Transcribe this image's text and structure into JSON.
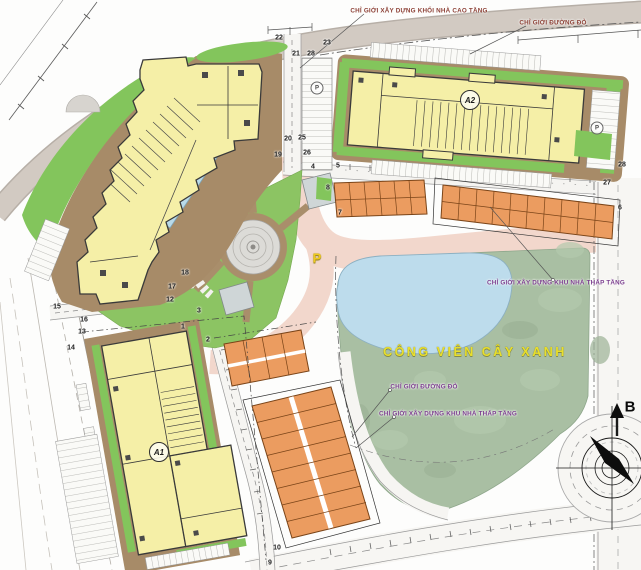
{
  "park": {
    "name": "CÔNG VIÊN CÂY XANH"
  },
  "compass": {
    "north_label": "B"
  },
  "buildings": {
    "a1_label": "A1",
    "a2_label": "A2",
    "parking_big_label": "P",
    "parking_lot_left_label": "P",
    "parking_lot_right_label": "P"
  },
  "annotations": [
    {
      "id": "boundary-highrise",
      "text": "CHỈ GIỚI XÂY DỰNG KHỐI NHÀ CAO TẦNG",
      "x": 419,
      "y": 11,
      "cls": "red"
    },
    {
      "id": "red-line-top",
      "text": "CHỈ GIỚI ĐƯỜNG ĐỎ",
      "x": 553,
      "y": 23,
      "cls": "red"
    },
    {
      "id": "boundary-lowrise-right",
      "text": "CHỈ GIỚI XÂY DỰNG KHU NHÀ THẤP TẦNG",
      "x": 556,
      "y": 283,
      "cls": "purple"
    },
    {
      "id": "red-line-park",
      "text": "CHỈ GIỚI ĐƯỜNG ĐỎ",
      "x": 424,
      "y": 387,
      "cls": "purple"
    },
    {
      "id": "boundary-lowrise-park",
      "text": "CHỈ GIỚI XÂY DỰNG KHU NHÀ THẤP TẦNG",
      "x": 448,
      "y": 414,
      "cls": "purple"
    }
  ],
  "markers": [
    {
      "n": "22",
      "x": 279,
      "y": 38
    },
    {
      "n": "23",
      "x": 327,
      "y": 43
    },
    {
      "n": "21",
      "x": 296,
      "y": 54
    },
    {
      "n": "28",
      "x": 311,
      "y": 54
    },
    {
      "n": "20",
      "x": 288,
      "y": 139
    },
    {
      "n": "25",
      "x": 302,
      "y": 138
    },
    {
      "n": "19",
      "x": 278,
      "y": 155
    },
    {
      "n": "26",
      "x": 307,
      "y": 153
    },
    {
      "n": "4",
      "x": 313,
      "y": 167
    },
    {
      "n": "5",
      "x": 338,
      "y": 166
    },
    {
      "n": "8",
      "x": 328,
      "y": 188
    },
    {
      "n": "7",
      "x": 340,
      "y": 213
    },
    {
      "n": "28",
      "x": 622,
      "y": 165
    },
    {
      "n": "27",
      "x": 607,
      "y": 183
    },
    {
      "n": "6",
      "x": 620,
      "y": 208
    },
    {
      "n": "18",
      "x": 185,
      "y": 273
    },
    {
      "n": "17",
      "x": 172,
      "y": 287
    },
    {
      "n": "12",
      "x": 170,
      "y": 300
    },
    {
      "n": "3",
      "x": 199,
      "y": 311
    },
    {
      "n": "1",
      "x": 183,
      "y": 327
    },
    {
      "n": "2",
      "x": 208,
      "y": 340
    },
    {
      "n": "15",
      "x": 57,
      "y": 307
    },
    {
      "n": "16",
      "x": 84,
      "y": 320
    },
    {
      "n": "13",
      "x": 82,
      "y": 332
    },
    {
      "n": "14",
      "x": 71,
      "y": 348
    },
    {
      "n": "9",
      "x": 270,
      "y": 563
    },
    {
      "n": "10",
      "x": 277,
      "y": 548
    }
  ],
  "colors": {
    "building_yellow": "#f5efa7",
    "townhouse_orange": "#eb9c60",
    "lawn_green": "#83c55c",
    "park_green": "#a9bfa3",
    "lake_blue": "#bddcec",
    "road_pink": "#f2d7cc",
    "pavement_brown": "#a78b68",
    "road_gray": "#d2cac2",
    "label_purple": "#7c3e8f",
    "label_red": "#8d4136",
    "park_text_yellow": "#e9df2b"
  }
}
